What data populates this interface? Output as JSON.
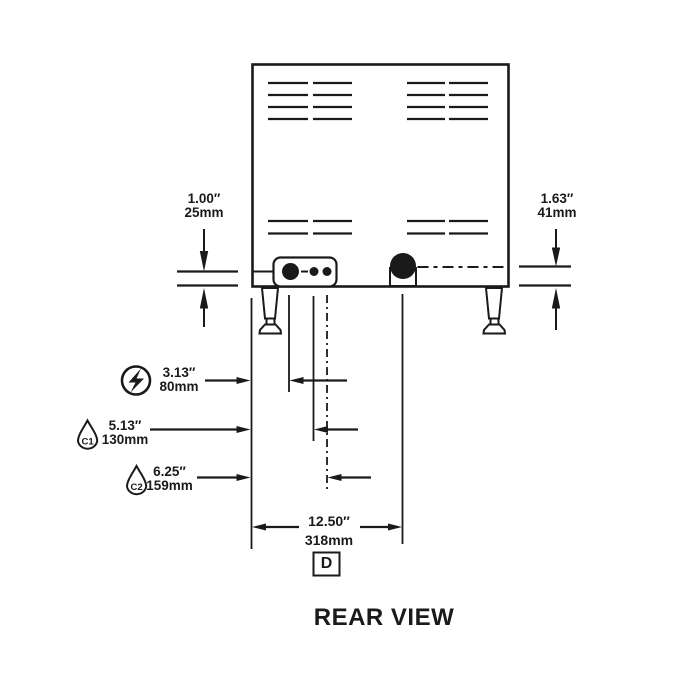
{
  "diagram": {
    "title": "REAR VIEW",
    "detail_label": "D",
    "dims": {
      "left_offset": {
        "inches": "1.00″",
        "metric": "25mm"
      },
      "right_offset": {
        "inches": "1.63″",
        "metric": "41mm"
      },
      "electrical": {
        "inches": "3.13″",
        "metric": "80mm",
        "icon": "lightning-bolt-icon"
      },
      "c1_water": {
        "inches": "5.13″",
        "metric": "130mm",
        "label": "C1",
        "icon": "water-drop-icon"
      },
      "c2_water": {
        "inches": "6.25″",
        "metric": "159mm",
        "label": "C2",
        "icon": "water-drop-icon"
      },
      "overall_width": {
        "inches": "12.50″",
        "metric": "318mm"
      }
    },
    "colors": {
      "line": "#1a1a1a",
      "background": "#ffffff"
    }
  }
}
